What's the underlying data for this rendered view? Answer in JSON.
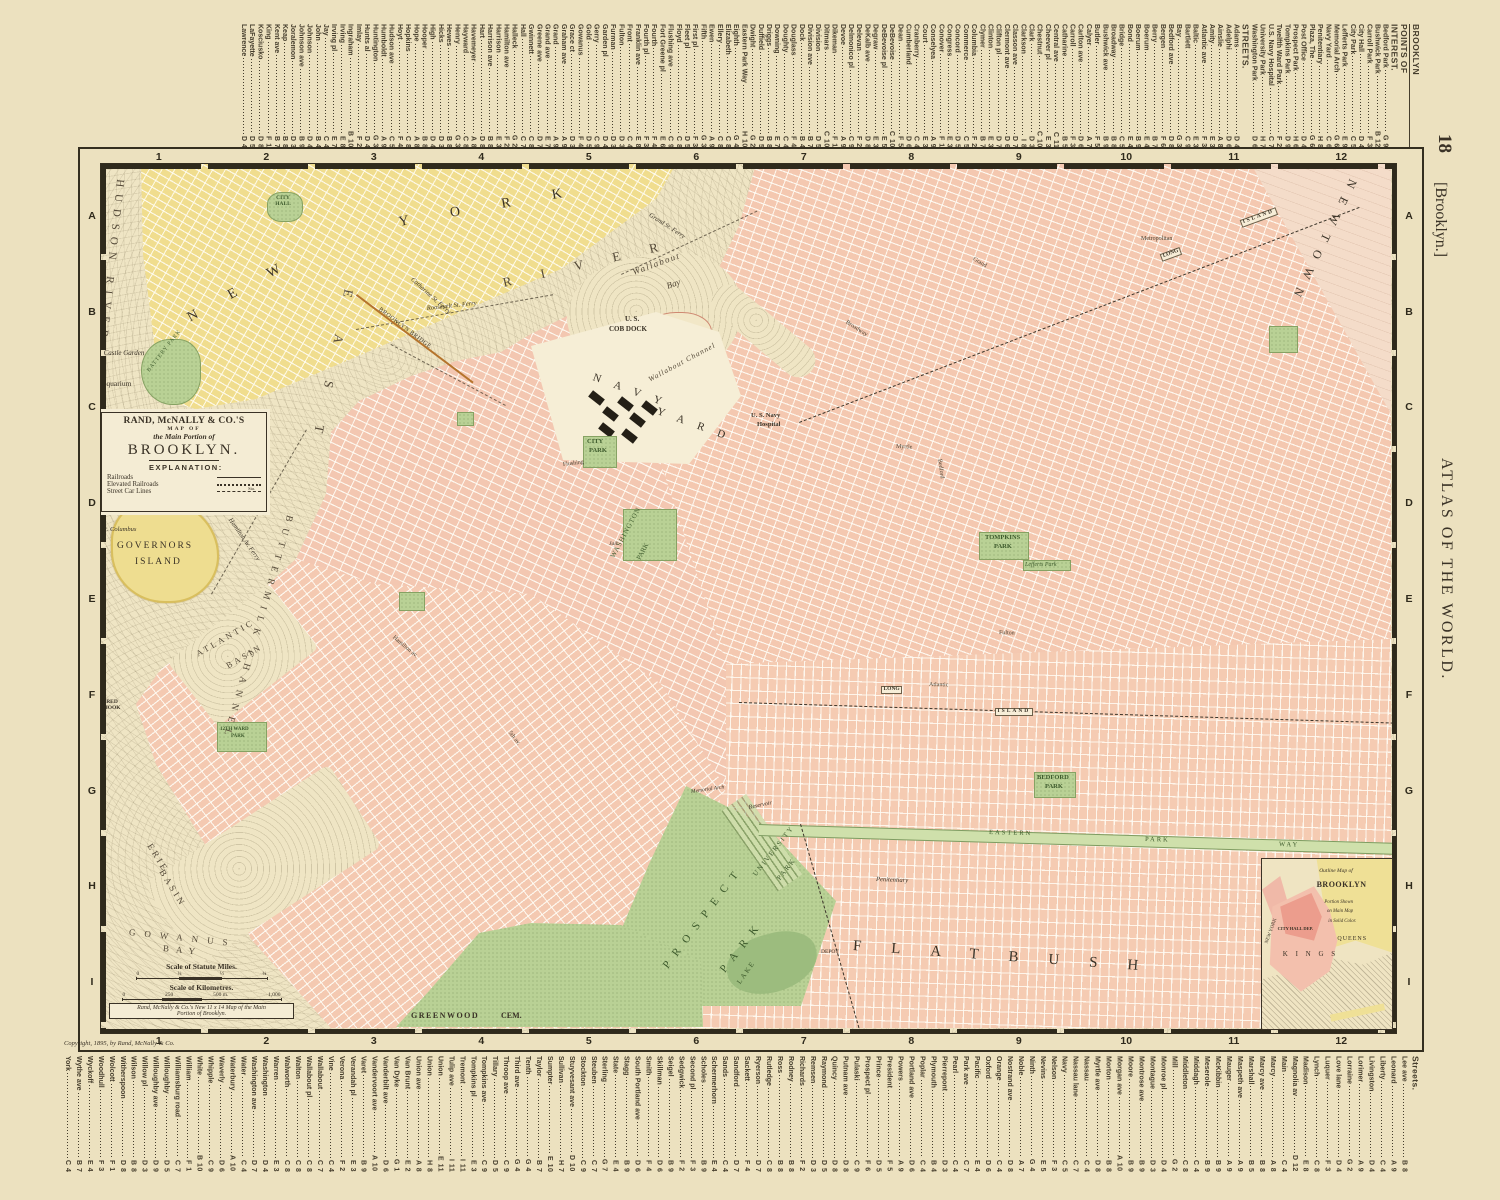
{
  "page": {
    "no": "18",
    "bracket": "[Brooklyn.]",
    "atlas": "ATLAS OF THE WORLD.",
    "copyright": "Copyright, 1895, by Rand, McNally & Co."
  },
  "frame": {
    "cols": [
      "1",
      "2",
      "3",
      "4",
      "5",
      "6",
      "7",
      "8",
      "9",
      "10",
      "11",
      "12"
    ],
    "rows": [
      "A",
      "B",
      "C",
      "D",
      "E",
      "F",
      "G",
      "H",
      "I"
    ]
  },
  "margins": {
    "top_entries": [
      {
        "n": "BROOKLYN",
        "c": "hdr hb"
      },
      {
        "n": "POINTS OF",
        "c": "hdr"
      },
      {
        "n": "INTEREST.",
        "c": "hdr"
      },
      {
        "n": "Bedford Park",
        "r": "G 9"
      },
      {
        "n": "Bushwick Park",
        "r": "B 12"
      },
      {
        "n": "Carroll Park",
        "r": "F 3"
      },
      {
        "n": "City Hall",
        "r": "D 4"
      },
      {
        "n": "City Park",
        "r": "C 5"
      },
      {
        "n": "Lefferts Park",
        "r": "E 9"
      },
      {
        "n": "Memorial Arch",
        "r": "G 6"
      },
      {
        "n": "Navy Yard",
        "r": "C 6"
      },
      {
        "n": "Penitentiary",
        "r": "H 8"
      },
      {
        "n": "Plaza, The",
        "r": "G 6"
      },
      {
        "n": "Post Office",
        "r": "D 4"
      },
      {
        "n": "Prospect Park",
        "r": "H 6"
      },
      {
        "n": "Tompkins Park",
        "r": "D 9"
      },
      {
        "n": "Twelfth Ward Park",
        "r": "F 2"
      },
      {
        "n": "U.S. Navy Hospital",
        "r": "C 7"
      },
      {
        "n": "University Park",
        "r": "H 7"
      },
      {
        "n": "Washington Park",
        "r": "D 6"
      },
      {
        "n": "STREETS.",
        "c": "hdr"
      },
      {
        "n": "Adams",
        "r": "D 4"
      },
      {
        "n": "Adelphi",
        "r": "D 6"
      },
      {
        "n": "Ainslie",
        "r": "A 8"
      },
      {
        "n": "Amity",
        "r": "E 3"
      },
      {
        "n": "Atlantic ave",
        "r": "F 3"
      },
      {
        "n": "Baltic",
        "r": "E 3"
      },
      {
        "n": "Bartlett",
        "r": "C 9"
      },
      {
        "n": "Bay",
        "r": "G 3"
      },
      {
        "n": "Bedford ave",
        "r": "D 8"
      },
      {
        "n": "Bergen",
        "r": "F 6"
      },
      {
        "n": "Berry",
        "r": "B 7"
      },
      {
        "n": "Boerum",
        "r": "E 4"
      },
      {
        "n": "Boerum",
        "r": "B 9"
      },
      {
        "n": "Bond",
        "r": "E 4"
      },
      {
        "n": "Bridge",
        "r": "C 5"
      },
      {
        "n": "Broadway",
        "r": "B 8"
      },
      {
        "n": "Bushwick ave",
        "r": "B 9"
      },
      {
        "n": "Butler",
        "r": "F 5"
      },
      {
        "n": "Calyer",
        "r": "A 7"
      },
      {
        "n": "Carlton ave",
        "r": "D 6"
      },
      {
        "n": "Carroll",
        "r": "F 3"
      },
      {
        "n": "Catharine",
        "r": "B 5"
      },
      {
        "n": "Central ave",
        "r": "C 11"
      },
      {
        "n": "Cheever pl",
        "r": "E 3"
      },
      {
        "n": "Chestnut",
        "r": "C 10"
      },
      {
        "n": "Clark",
        "r": "D 3"
      },
      {
        "n": "Clarkson",
        "r": "I 8"
      },
      {
        "n": "Classon ave",
        "r": "D 7"
      },
      {
        "n": "Clermont ave",
        "r": "D 6"
      },
      {
        "n": "Clifton pl",
        "r": "D 7"
      },
      {
        "n": "Clinton",
        "r": "E 3"
      },
      {
        "n": "Clymer",
        "r": "B 7"
      },
      {
        "n": "Columbia",
        "r": "F 2"
      },
      {
        "n": "Commerce",
        "r": "C 5"
      },
      {
        "n": "Concord",
        "r": "D 5"
      },
      {
        "n": "Congress",
        "r": "E 3"
      },
      {
        "n": "Conover",
        "r": "F 1"
      },
      {
        "n": "Conselyea",
        "r": "A 9"
      },
      {
        "n": "Court",
        "r": "E 3"
      },
      {
        "n": "Cranberry",
        "r": "C 4"
      },
      {
        "n": "Cumberland",
        "r": "D 6"
      },
      {
        "n": "Dean",
        "r": "F 5"
      },
      {
        "n": "DeBevoise",
        "r": "C 10"
      },
      {
        "n": "DeBevoise pl",
        "r": "E 5"
      },
      {
        "n": "Degraw",
        "r": "E 3"
      },
      {
        "n": "DeKalb ave",
        "r": "D 8"
      },
      {
        "n": "Delevan",
        "r": "F 2"
      },
      {
        "n": "Delmonico pl",
        "r": "C 9"
      },
      {
        "n": "Devoe",
        "r": "A 9"
      },
      {
        "n": "Dikeman",
        "r": "F 1"
      },
      {
        "n": "Ditmars",
        "r": "C 10"
      },
      {
        "n": "Division",
        "r": "D 5"
      },
      {
        "n": "Division ave",
        "r": "B 7"
      },
      {
        "n": "Dock",
        "r": "B 4"
      },
      {
        "n": "Douglass",
        "r": "F 4"
      },
      {
        "n": "Doughty",
        "r": "C 4"
      },
      {
        "n": "Downing",
        "r": "E 7"
      },
      {
        "n": "Driggs",
        "r": "B 8"
      },
      {
        "n": "Duffield",
        "r": "D 5"
      },
      {
        "n": "Dwight",
        "r": "G 2"
      },
      {
        "n": "Eastern Park Way",
        "r": "H 10"
      },
      {
        "n": "Eighth",
        "r": "G 4"
      },
      {
        "n": "Elizabeth",
        "r": "C 8"
      },
      {
        "n": "Ellery",
        "r": "C 8"
      },
      {
        "n": "Ewen",
        "r": "A 9"
      },
      {
        "n": "Fifth",
        "r": "G 3"
      },
      {
        "n": "First pl",
        "r": "F 3"
      },
      {
        "n": "Fleet pl",
        "r": "D 5"
      },
      {
        "n": "Floyd",
        "r": "C 8"
      },
      {
        "n": "Flushing ave",
        "r": "C 9"
      },
      {
        "n": "Fort Greene pl",
        "r": "E 6"
      },
      {
        "n": "Fourth",
        "r": "F 4"
      },
      {
        "n": "Fourth pl",
        "r": "F 3"
      },
      {
        "n": "Franklin ave",
        "r": "E 8"
      },
      {
        "n": "Front",
        "r": "C 4"
      },
      {
        "n": "Fulton",
        "r": "D 3"
      },
      {
        "n": "Furman",
        "r": "D 3"
      },
      {
        "n": "Garden pl",
        "r": "D 4"
      },
      {
        "n": "Gerry",
        "r": "C 9"
      },
      {
        "n": "Gold",
        "r": "D 5"
      },
      {
        "n": "Gowanus",
        "r": "F 4"
      },
      {
        "n": "Grace ct",
        "r": "D 3"
      },
      {
        "n": "Graham ave",
        "r": "A 9"
      },
      {
        "n": "Grand",
        "r": "A 9"
      },
      {
        "n": "Grand ave",
        "r": "E 7"
      },
      {
        "n": "Greene ave",
        "r": "D 7"
      },
      {
        "n": "Gwinnett",
        "r": "C 8"
      },
      {
        "n": "Hall",
        "r": "C 7"
      },
      {
        "n": "Halleck",
        "r": "G 2"
      },
      {
        "n": "Hamilton ave",
        "r": "F 2"
      },
      {
        "n": "Harrison",
        "r": "E 3"
      },
      {
        "n": "Harrison ave",
        "r": "B 8"
      },
      {
        "n": "Hart",
        "r": "D 8"
      },
      {
        "n": "Havemeyer",
        "r": "A 8"
      },
      {
        "n": "Hayward",
        "r": "C 8"
      },
      {
        "n": "Henry",
        "r": "G 3"
      },
      {
        "n": "Hewes",
        "r": "B 8"
      },
      {
        "n": "Hicks",
        "r": "D 3"
      },
      {
        "n": "High",
        "r": "D 4"
      },
      {
        "n": "Hooper",
        "r": "B 8"
      },
      {
        "n": "Hope",
        "r": "A 8"
      },
      {
        "n": "Hopkins",
        "r": "C 8"
      },
      {
        "n": "Hoyt",
        "r": "F 4"
      },
      {
        "n": "Hudson ave",
        "r": "C 5"
      },
      {
        "n": "Humboldt",
        "r": "A 9"
      },
      {
        "n": "Huntington",
        "r": "G 3"
      },
      {
        "n": "Hunts al",
        "r": "D 4"
      },
      {
        "n": "Imlay",
        "r": "F 2"
      },
      {
        "n": "Ingraham",
        "r": "B 10"
      },
      {
        "n": "Irving",
        "r": "E 8"
      },
      {
        "n": "Irving pl",
        "r": "E 7"
      },
      {
        "n": "Jay",
        "r": "C 4"
      },
      {
        "n": "John",
        "r": "B 4"
      },
      {
        "n": "Johnson",
        "r": "D 4"
      },
      {
        "n": "Johnson ave",
        "r": "B 9"
      },
      {
        "n": "Joralemon",
        "r": "D 3"
      },
      {
        "n": "Keap",
        "r": "B 8"
      },
      {
        "n": "Kent ave",
        "r": "B 7"
      },
      {
        "n": "King",
        "r": "F 1"
      },
      {
        "n": "Kosciusko",
        "r": "D 8"
      },
      {
        "n": "LaFayette",
        "r": "D 5"
      },
      {
        "n": "Lawrence",
        "r": "D 4"
      }
    ],
    "bottom_entries": [
      {
        "n": "Streets.",
        "c": "hdr"
      },
      {
        "n": "Lee ave",
        "r": "B 8"
      },
      {
        "n": "Leonard",
        "r": "A 9"
      },
      {
        "n": "Liberty",
        "r": "C 4"
      },
      {
        "n": "Livingston",
        "r": "D 4"
      },
      {
        "n": "Lorimer",
        "r": "A 9"
      },
      {
        "n": "Lorraine",
        "r": "G 2"
      },
      {
        "n": "Love lane",
        "r": "D 4"
      },
      {
        "n": "Luquer",
        "r": "F 3"
      },
      {
        "n": "Lynch",
        "r": "C 8"
      },
      {
        "n": "Madison",
        "r": "E 8"
      },
      {
        "n": "Magnolia av",
        "r": "D 12"
      },
      {
        "n": "Main",
        "r": "C 4"
      },
      {
        "n": "Marcy",
        "r": "A 8"
      },
      {
        "n": "Marcy ave",
        "r": "B 8"
      },
      {
        "n": "Marshall",
        "r": "B 5"
      },
      {
        "n": "Maspeth ave",
        "r": "A 9"
      },
      {
        "n": "Mauger",
        "r": "A 9"
      },
      {
        "n": "McKibbin",
        "r": "B 9"
      },
      {
        "n": "Meserole",
        "r": "B 9"
      },
      {
        "n": "Middagh",
        "r": "C 4"
      },
      {
        "n": "Middleton",
        "r": "C 8"
      },
      {
        "n": "Mill",
        "r": "G 2"
      },
      {
        "n": "Monroe pl",
        "r": "D 4"
      },
      {
        "n": "Montague",
        "r": "D 3"
      },
      {
        "n": "Montrose ave",
        "r": "B 9"
      },
      {
        "n": "Moore",
        "r": "B 9"
      },
      {
        "n": "Morgan ave",
        "r": "A 10"
      },
      {
        "n": "Morton",
        "r": "B 8"
      },
      {
        "n": "Myrtle ave",
        "r": "D 8"
      },
      {
        "n": "Nassau",
        "r": "C 4"
      },
      {
        "n": "Nassau lane",
        "r": "C 7"
      },
      {
        "n": "Navy",
        "r": "C 5"
      },
      {
        "n": "Nelson",
        "r": "F 3"
      },
      {
        "n": "Nevins",
        "r": "E 5"
      },
      {
        "n": "Ninth",
        "r": "G 4"
      },
      {
        "n": "Noble",
        "r": "A 7"
      },
      {
        "n": "Nostrand ave",
        "r": "D 8"
      },
      {
        "n": "Orange",
        "r": "C 4"
      },
      {
        "n": "Oxford",
        "r": "D 6"
      },
      {
        "n": "Pacific",
        "r": "E 4"
      },
      {
        "n": "Park ave",
        "r": "C 7"
      },
      {
        "n": "Pearl",
        "r": "C 4"
      },
      {
        "n": "Pierrepont",
        "r": "D 3"
      },
      {
        "n": "Plymouth",
        "r": "B 4"
      },
      {
        "n": "Poplar",
        "r": "C 4"
      },
      {
        "n": "Portland ave",
        "r": "D 6"
      },
      {
        "n": "Powers",
        "r": "A 9"
      },
      {
        "n": "President",
        "r": "F 5"
      },
      {
        "n": "Prince",
        "r": "D 5"
      },
      {
        "n": "Prospect pl",
        "r": "F 6"
      },
      {
        "n": "Pulaski",
        "r": "C 9"
      },
      {
        "n": "Putnam ave",
        "r": "D 8"
      },
      {
        "n": "Quincy",
        "r": "D 8"
      },
      {
        "n": "Raymond",
        "r": "D 5"
      },
      {
        "n": "Remsen",
        "r": "D 3"
      },
      {
        "n": "Richards",
        "r": "F 2"
      },
      {
        "n": "Rodney",
        "r": "B 8"
      },
      {
        "n": "Ross",
        "r": "B 8"
      },
      {
        "n": "Rutledge",
        "r": "C 8"
      },
      {
        "n": "Ryerson",
        "r": "D 7"
      },
      {
        "n": "Sackett",
        "r": "F 4"
      },
      {
        "n": "Sandford",
        "r": "D 7"
      },
      {
        "n": "Sands",
        "r": "C 4"
      },
      {
        "n": "Schermerhorn",
        "r": "E 4"
      },
      {
        "n": "Scholes",
        "r": "B 9"
      },
      {
        "n": "Second pl",
        "r": "F 3"
      },
      {
        "n": "Sedgwick",
        "r": "F 2"
      },
      {
        "n": "Seigel",
        "r": "B 9"
      },
      {
        "n": "Skillman",
        "r": "D 6"
      },
      {
        "n": "Smith",
        "r": "F 4"
      },
      {
        "n": "South Portland ave",
        "r": "D 6"
      },
      {
        "n": "Stagg",
        "r": "B 9"
      },
      {
        "n": "State",
        "r": "E 4"
      },
      {
        "n": "Sterling",
        "r": "G 7"
      },
      {
        "n": "Steuben",
        "r": "C 7"
      },
      {
        "n": "Stockton",
        "r": "C 9"
      },
      {
        "n": "Stuyvesant ave",
        "r": "D 10"
      },
      {
        "n": "Sullivan",
        "r": "H 7"
      },
      {
        "n": "Sumpter",
        "r": "E 10"
      },
      {
        "n": "Taylor",
        "r": "B 7"
      },
      {
        "n": "Tenth",
        "r": "G 4"
      },
      {
        "n": "Third ave",
        "r": "G 4"
      },
      {
        "n": "Throop ave",
        "r": "C 9"
      },
      {
        "n": "Tillary",
        "r": "D 5"
      },
      {
        "n": "Tompkins ave",
        "r": "C 9"
      },
      {
        "n": "Tompkins pl",
        "r": "E 3"
      },
      {
        "n": "Tremont",
        "r": "I 11"
      },
      {
        "n": "Tulip ave",
        "r": "I 11"
      },
      {
        "n": "Union",
        "r": "E 11"
      },
      {
        "n": "Union",
        "r": "H 8"
      },
      {
        "n": "Union ave",
        "r": "A 8"
      },
      {
        "n": "Van Brunt",
        "r": "E 2"
      },
      {
        "n": "Van Dyke",
        "r": "G 1"
      },
      {
        "n": "Vanderbilt ave",
        "r": "D 6"
      },
      {
        "n": "Vandervoort ave",
        "r": "A 10"
      },
      {
        "n": "Varet",
        "r": "B 9"
      },
      {
        "n": "Verandah pl",
        "r": "E 3"
      },
      {
        "n": "Verona",
        "r": "F 2"
      },
      {
        "n": "Vine",
        "r": "C 4"
      },
      {
        "n": "Wallabout",
        "r": "C 7"
      },
      {
        "n": "Wallabout pl",
        "r": "C 8"
      },
      {
        "n": "Walton",
        "r": "C 8"
      },
      {
        "n": "Walworth",
        "r": "C 8"
      },
      {
        "n": "Warren",
        "r": "E 3"
      },
      {
        "n": "Washington",
        "r": "D 4"
      },
      {
        "n": "Washington ave",
        "r": "D 7"
      },
      {
        "n": "Water",
        "r": "C 4"
      },
      {
        "n": "Waterbury",
        "r": "A 10"
      },
      {
        "n": "Waverly",
        "r": "D 6"
      },
      {
        "n": "Whipple",
        "r": "C 9"
      },
      {
        "n": "White",
        "r": "B 10"
      },
      {
        "n": "William",
        "r": "F 1"
      },
      {
        "n": "Williamsburg road",
        "r": "C 7"
      },
      {
        "n": "Willoughby",
        "r": "D 5"
      },
      {
        "n": "Willoughby ave",
        "r": "D 9"
      },
      {
        "n": "Willow pl",
        "r": "D 3"
      },
      {
        "n": "Wilson",
        "r": "B 8"
      },
      {
        "n": "Witherspoon",
        "r": "D 8"
      },
      {
        "n": "Wolcott",
        "r": "F 1"
      },
      {
        "n": "Woodhull",
        "r": "F 3"
      },
      {
        "n": "Wyckoff",
        "r": "E 4"
      },
      {
        "n": "Wythe ave",
        "r": "B 7"
      },
      {
        "n": "York",
        "r": "C 4"
      }
    ]
  },
  "cartouche": {
    "l1": "RAND, McNALLY & CO.'S",
    "l2": "MAP OF",
    "l3": "the Main Portion of",
    "l4": "BROOKLYN.",
    "l5": "EXPLANATION:",
    "leg1": "Railroads",
    "leg2": "Elevated Railroads",
    "leg3": "Street Car Lines",
    "sta": "Sta."
  },
  "scale": {
    "miles": "Scale of Statute Miles.",
    "mt": [
      "0",
      "¼",
      "½",
      "¾"
    ],
    "km": "Scale of Kilometres.",
    "kt": [
      "0",
      "250",
      "500 m.",
      "1,000"
    ],
    "n1": "Rand, McNally & Co.'s New 11 x 14 Map of the Main",
    "n2": "Portion of Brooklyn."
  },
  "labels": {
    "hudson": "HUDSON RIVER",
    "east": "EAST",
    "river": "RIVER",
    "new_york_1": "NEW",
    "new_york_2": "YORK",
    "city_hall_ny": "CITY HALL",
    "battery": "BATTERY PARK",
    "castle_garden": "Castle Garden",
    "aquarium": "Aquarium",
    "governors_1": "GOVERNORS",
    "governors_2": "ISLAND",
    "castle_william": "Castle William",
    "ft_columbus": "Ft. Columbus",
    "buttermilk": "BUTTERMILK CHANNEL",
    "atlantic_basin_1": "ATLANTIC",
    "atlantic_basin_2": "BASIN",
    "erie_1": "ERIE",
    "erie_2": "BASIN",
    "gowanus_1": "GOWANUS",
    "gowanus_2": "BAY",
    "red_hook": "RED HOOK",
    "bridge": "BROOKLYN BRIDGE",
    "roosevelt_ferry": "Roosevelt St. Ferry",
    "grand_ferry": "Grand St. Ferry",
    "catharine_ferry": "Catharine St. Ferry",
    "hamilton_ferry": "Hamilton Av. Ferry",
    "wallabout_1": "Wallabout",
    "wallabout_2": "Bay",
    "cob_1": "U. S.",
    "cob_2": "COB DOCK",
    "wallabout_channel": "Wallabout Channel",
    "navy": "NAVY",
    "yard": "YARD",
    "hospital_1": "U. S. Navy",
    "hospital_2": "Hospital",
    "city_park_1": "CITY",
    "city_park_2": "PARK",
    "washington_1": "WASHINGTON",
    "washington_2": "PARK",
    "jail": "Jail",
    "tompkins_1": "TOMPKINS",
    "tompkins_2": "PARK",
    "lefferts": "Lefferts Park",
    "bedford_1": "BEDFORD",
    "bedford_2": "PARK",
    "newtown": "NEWTOWN",
    "flatbush": "FLATBUSH",
    "prospect_1": "PROSPECT",
    "prospect_2": "PARK",
    "university_1": "UNIVERSITY",
    "university_2": "PARK",
    "lake": "LAKE",
    "reservoir": "Reservoir",
    "memorial_arch": "Memorial Arch",
    "penitentiary": "Penitentiary",
    "depot": "DEPOT",
    "greenwood_1": "GREENWOOD",
    "greenwood_2": "CEM.",
    "eastern": "EASTERN",
    "pkwy_park": "PARK",
    "pkwy_way": "WAY",
    "long_1": "LONG",
    "island_1": "ISLAND",
    "long_2": "LONG",
    "island_2": "ISLAND",
    "twelfth_1": "12TH WARD",
    "twelfth_2": "PARK",
    "broadway": "Broadway",
    "myrtle": "Myrtle",
    "fulton": "Fulton",
    "atlantic_st": "Atlantic",
    "flushing": "Flushing",
    "metropolitan": "Metropolitan",
    "grand_st": "Grand",
    "bedford_ave": "Bedford",
    "fifth_av": "5th av.",
    "hamilton_av": "Hamilton av."
  },
  "inset": {
    "l1": "Outline Map of",
    "l2": "BROOKLYN",
    "l3": "Portion Shown",
    "l4": "on Main Map",
    "l5": "in Solid Color.",
    "queens": "QUEENS",
    "kings": "K I N G S",
    "ny": "NEW YORK",
    "city_hall": "CITY HALL DEP."
  }
}
